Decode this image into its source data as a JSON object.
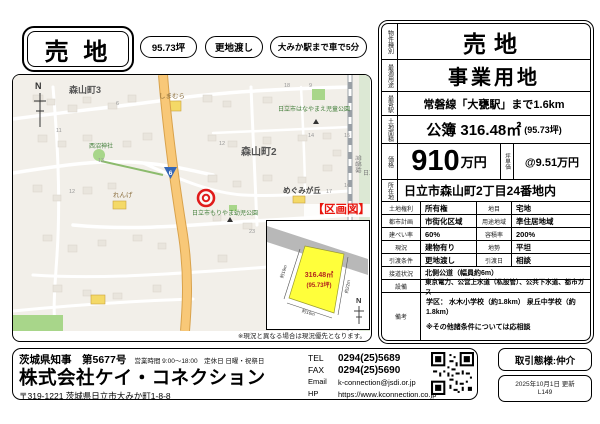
{
  "header": {
    "title": "売 地",
    "pills": [
      "95.73坪",
      "更地渡し",
      "大みか駅まで車で5分"
    ]
  },
  "map": {
    "labels": {
      "town3": "森山町3",
      "town2": "森山町2",
      "shimamura": "しまむら",
      "nishinuma_shrine": "西沼神社",
      "renge": "れんげ",
      "megumigaoka": "めぐみが丘",
      "hanayama_park": "日立市はなやまえ児童公園",
      "moriyama_park": "日立市もりやま幼児公園",
      "joban_line": "常磐線",
      "hitachi_partial": "日立",
      "route_number": "6",
      "north": "N"
    },
    "block_numbers": [
      "11",
      "13",
      "12",
      "6",
      "18",
      "9",
      "14",
      "15",
      "12",
      "16",
      "17",
      "23"
    ],
    "disclaimer": "※現況と異なる場合は現況優先となります。"
  },
  "inset": {
    "title": "【区画図】",
    "area_m2": "316.48㎡",
    "area_tsubo": "(95.73坪)",
    "dim_left": "約19m",
    "dim_right": "約22m",
    "dim_bottom": "約16m",
    "north": "N"
  },
  "spec": {
    "property_type": {
      "label": "物件種別",
      "value": "売地"
    },
    "best_use": {
      "label": "最適用途",
      "value": "事業用地"
    },
    "station": {
      "label": "最寄駅",
      "value": "常磐線「大甕駅」まで1.6km"
    },
    "land_area": {
      "label": "土地面積",
      "value": "公簿 316.48㎡",
      "note": "(95.73坪)"
    },
    "price": {
      "label": "価格",
      "value": "910",
      "unit": "万円",
      "tsubo_label": "坪単価",
      "tsubo_value": "@9.51万円"
    },
    "address": {
      "label": "所在地",
      "value": "日立市森山町2丁目24番地内"
    },
    "rows": [
      {
        "l1": "土地権利",
        "v1": "所有権",
        "l2": "地目",
        "v2": "宅地"
      },
      {
        "l1": "都市計画",
        "v1": "市街化区域",
        "l2": "用途地域",
        "v2": "準住居地域"
      },
      {
        "l1": "建ぺい率",
        "v1": "60%",
        "l2": "容積率",
        "v2": "200%"
      },
      {
        "l1": "現況",
        "v1": "建物有り",
        "l2": "地勢",
        "v2": "平坦"
      },
      {
        "l1": "引渡条件",
        "v1": "更地渡し",
        "l2": "引渡日",
        "v2": "相談"
      }
    ],
    "road": {
      "label": "接道状況",
      "value": "北側公道（幅員約6m）"
    },
    "utilities": {
      "label": "設備",
      "value": "東京電力、公営上水道（私設管）、公共下水道、都市ガス"
    },
    "remarks": {
      "label": "備考",
      "line1": "学区： 水木小学校（約1.8km） 泉丘中学校（約1.8km）",
      "line2": "※その他諸条件については応相談"
    }
  },
  "company": {
    "license": "茨城県知事　第5677号",
    "hours": "営業時間 9:00～18:00　定休日 日曜・祝祭日",
    "name": "株式会社ケイ・コネクション",
    "address": "〒319-1221 茨城県日立市大みか町1-8-8",
    "tel_label": "TEL",
    "tel": "0294(25)5689",
    "fax_label": "FAX",
    "fax": "0294(25)5690",
    "email_label": "Email",
    "email": "k-connection@jsdi.or.jp",
    "hp_label": "HP",
    "hp": "https://www.kconnection.co.jp"
  },
  "footer_boxes": {
    "transaction": "取引態様:仲介",
    "updated": "2025年10月1日 更新",
    "code": "L149"
  },
  "colors": {
    "accent_red": "#e8150d",
    "marker_red": "#e01b1b",
    "plot_yellow": "#ffff3b",
    "road_orange": "#f8c878"
  }
}
